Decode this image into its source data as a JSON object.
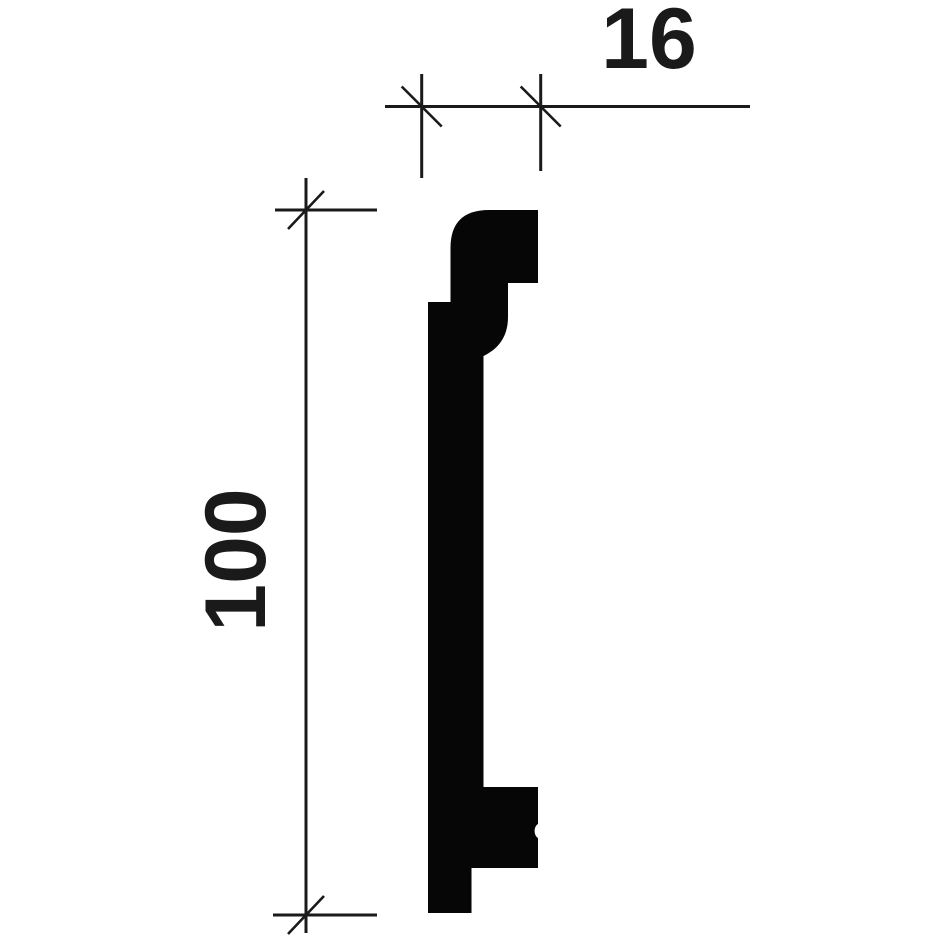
{
  "drawing": {
    "name": "molding-profile-cross-section",
    "width_dimension": {
      "value": "16",
      "orientation": "horizontal"
    },
    "height_dimension": {
      "value": "100",
      "orientation": "vertical"
    },
    "colors": {
      "ink": "#1a1a1a",
      "fill": "#060606",
      "background": "#ffffff"
    }
  }
}
